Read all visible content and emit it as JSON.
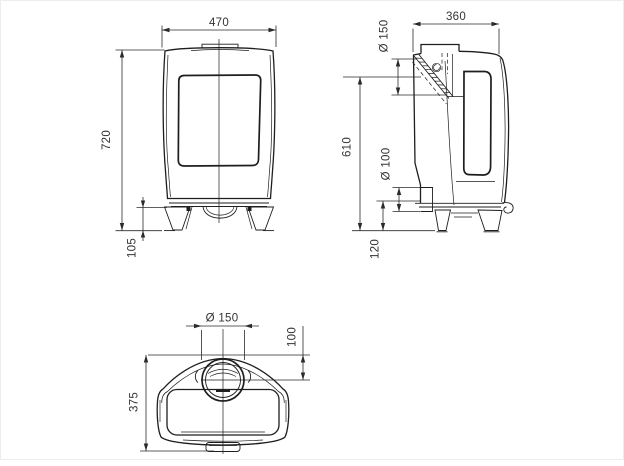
{
  "drawing": {
    "type": "technical-dimension-drawing",
    "subject": "wood stove, three orthographic views",
    "style": {
      "line_color": "#1e1e1e",
      "text_color": "#333333",
      "background": "#ffffff"
    },
    "views": {
      "front": {
        "title": "front view",
        "dims": {
          "width": "470",
          "height": "720",
          "leg_height": "105"
        }
      },
      "side": {
        "title": "side view",
        "dims": {
          "depth": "360",
          "rear_flue_diameter": "Ø 150",
          "flue_centre_height": "610",
          "air_inlet_diameter": "Ø 100",
          "air_inlet_height": "120"
        }
      },
      "top": {
        "title": "top view",
        "dims": {
          "flue_diameter": "Ø 150",
          "flue_centre_to_rear": "100",
          "total_depth": "375"
        }
      }
    }
  }
}
